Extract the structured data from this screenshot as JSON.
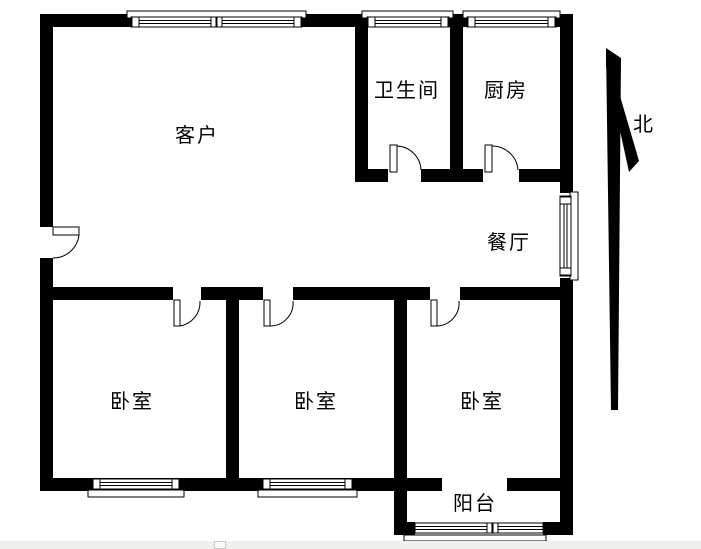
{
  "page": {
    "background": "#ffffff",
    "bottom_strip_color": "#f0f0ee"
  },
  "colors": {
    "wall": "#000000",
    "line": "#000000"
  },
  "compass": {
    "label": "北"
  },
  "rooms": {
    "living": {
      "label": "客户"
    },
    "bathroom": {
      "label": "卫生间"
    },
    "kitchen": {
      "label": "厨房"
    },
    "dining": {
      "label": "餐厅"
    },
    "bedroom_left": {
      "label": "卧室"
    },
    "bedroom_middle": {
      "label": "卧室"
    },
    "bedroom_right": {
      "label": "卧室"
    },
    "balcony": {
      "label": "阳台"
    }
  }
}
